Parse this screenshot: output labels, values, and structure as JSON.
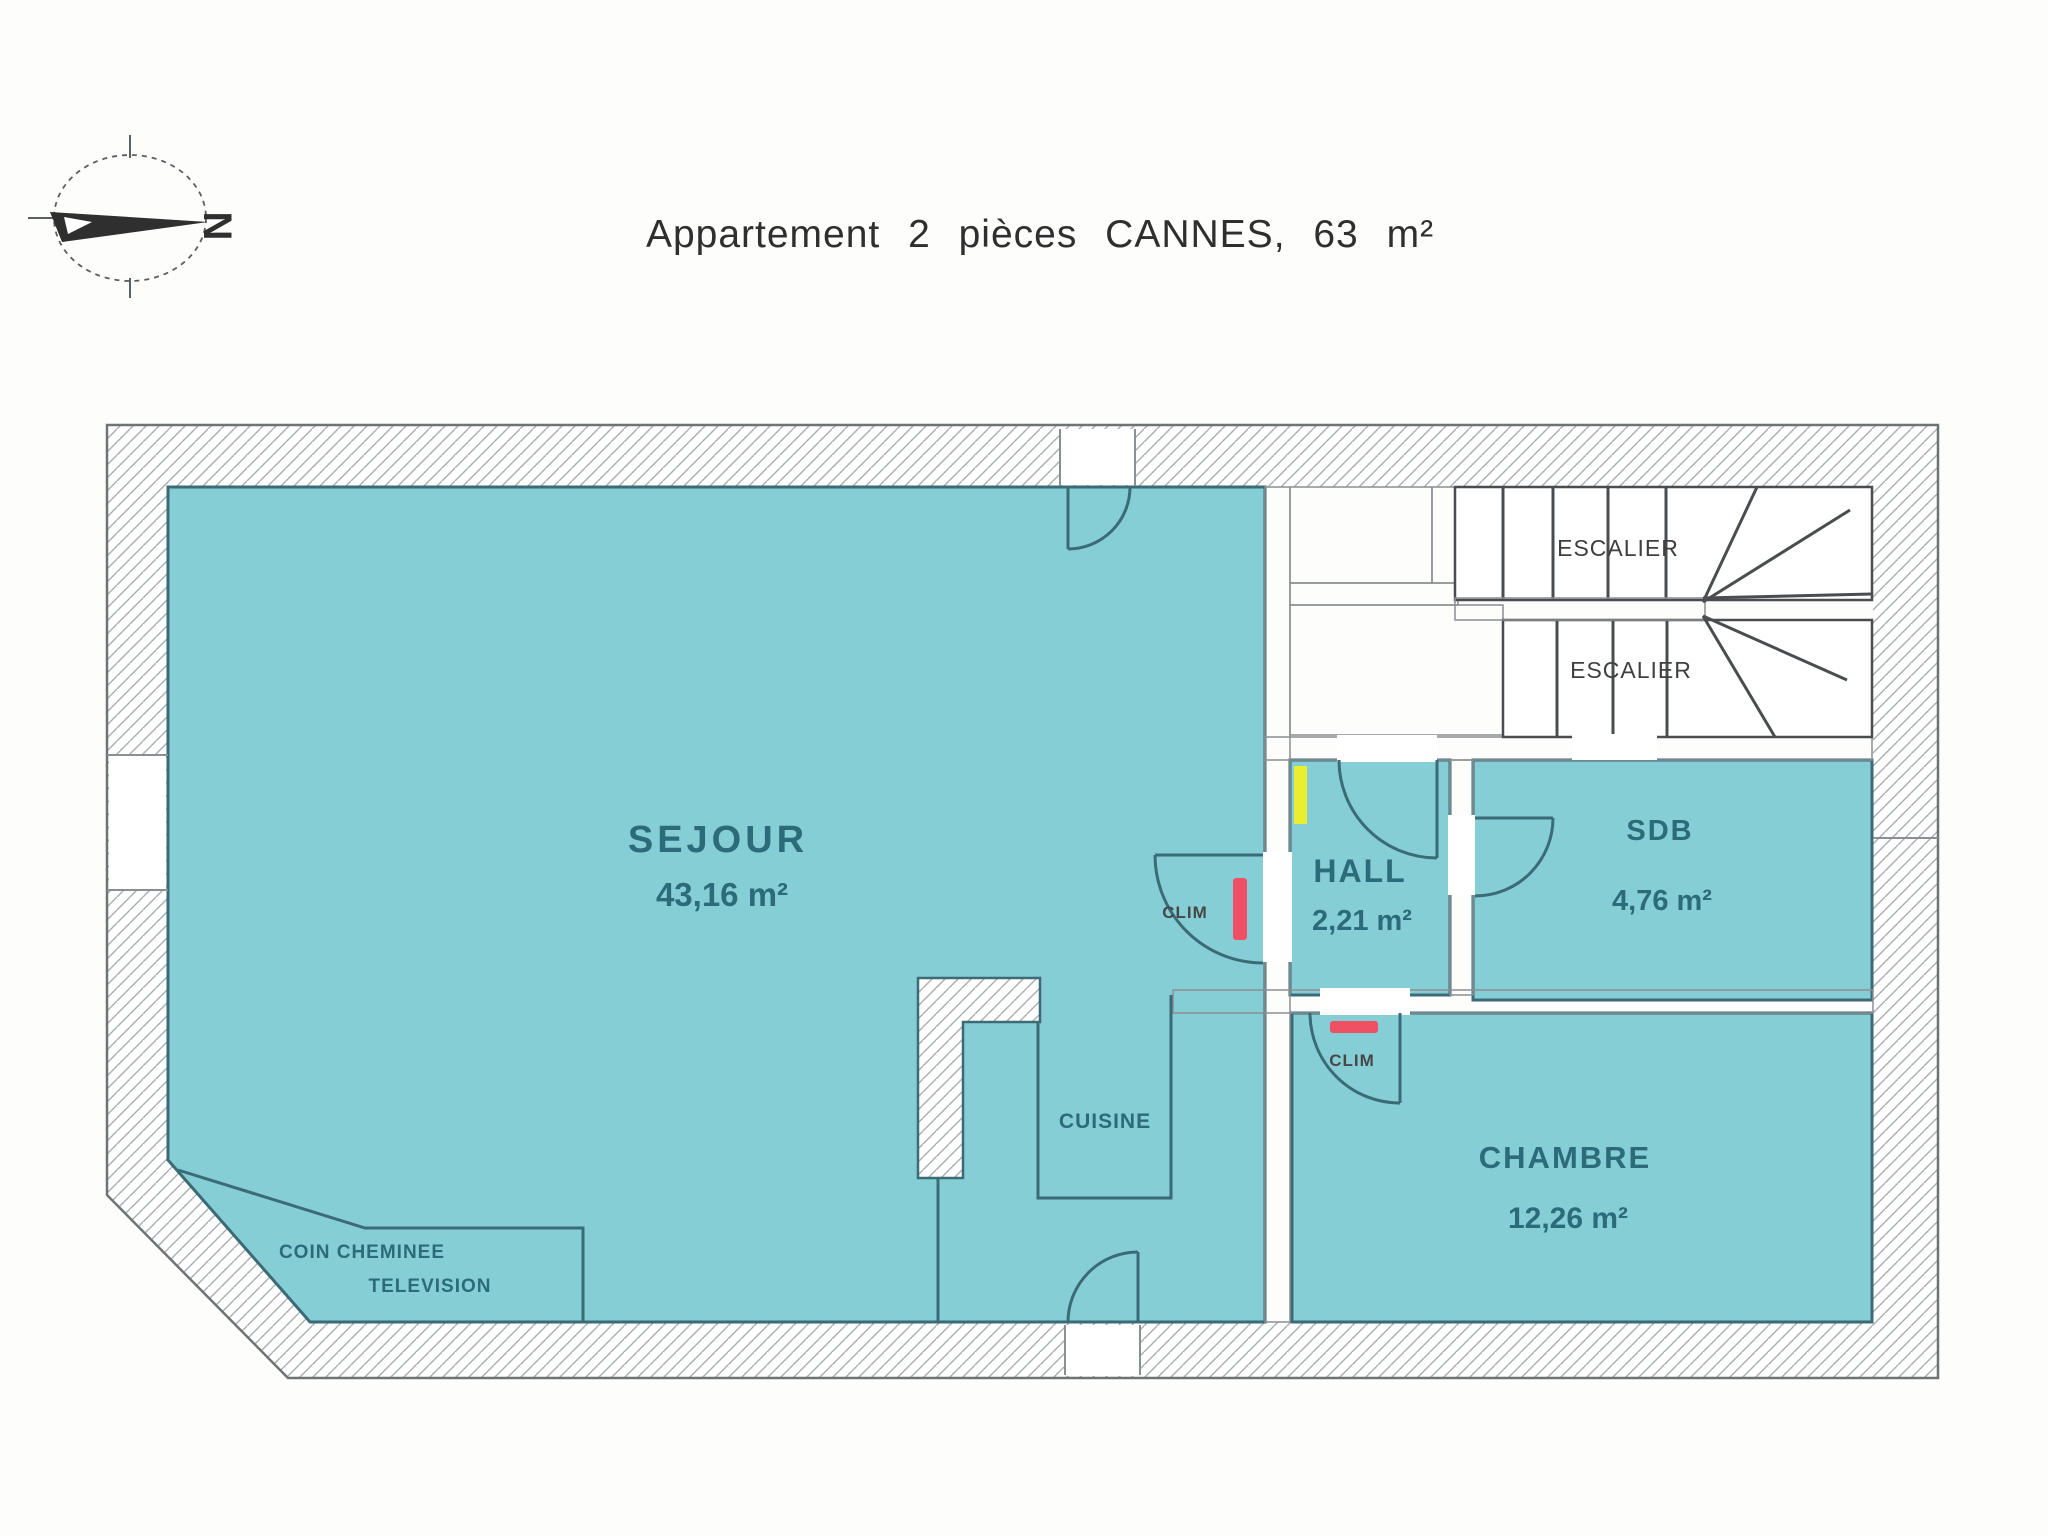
{
  "title": "Appartement 2 pièces CANNES, 63 m²",
  "compass": {
    "north_label": "N"
  },
  "rooms": {
    "sejour": {
      "name": "SEJOUR",
      "area": "43,16 m²"
    },
    "hall": {
      "name": "HALL",
      "area": "2,21 m²"
    },
    "sdb": {
      "name": "SDB",
      "area": "4,76 m²"
    },
    "chambre": {
      "name": "CHAMBRE",
      "area": "12,26 m²"
    },
    "cuisine": {
      "name": "CUISINE"
    },
    "coin_cheminee": {
      "line1": "COIN CHEMINEE",
      "line2": "TELEVISION"
    }
  },
  "stairs": {
    "upper_label": "ESCALIER",
    "lower_label": "ESCALIER"
  },
  "equipment": {
    "clim_sejour": "CLIM",
    "clim_chambre": "CLIM"
  },
  "colors": {
    "room_fill": "#86ced5",
    "clim_red": "#ef5064",
    "elec_yellow": "#e9ee2f",
    "line_dark": "#3a6b76"
  }
}
